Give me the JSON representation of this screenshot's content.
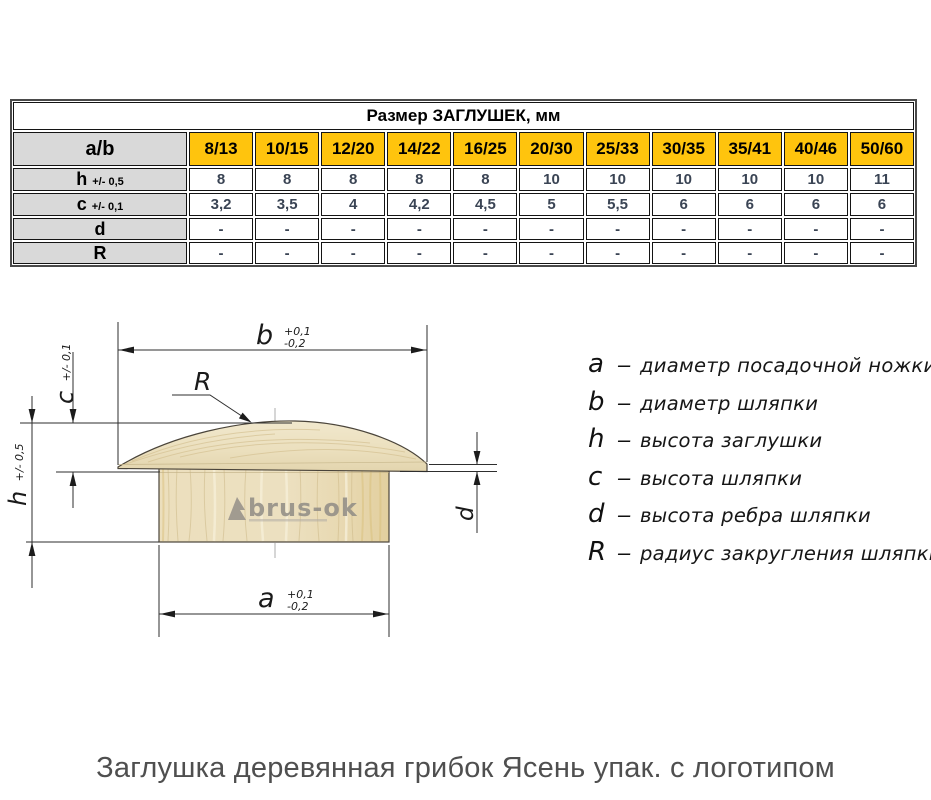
{
  "table": {
    "title": "Размер ЗАГЛУШЕК, мм",
    "corner_label": "a/b",
    "columns": [
      "8/13",
      "10/15",
      "12/20",
      "14/22",
      "16/25",
      "20/30",
      "25/33",
      "30/35",
      "35/41",
      "40/46",
      "50/60"
    ],
    "rows": [
      {
        "label": "h",
        "tolerance": "+/- 0,5",
        "values": [
          "8",
          "8",
          "8",
          "8",
          "8",
          "10",
          "10",
          "10",
          "10",
          "10",
          "11"
        ]
      },
      {
        "label": "c",
        "tolerance": "+/- 0,1",
        "values": [
          "3,2",
          "3,5",
          "4",
          "4,2",
          "4,5",
          "5",
          "5,5",
          "6",
          "6",
          "6",
          "6"
        ]
      },
      {
        "label": "d",
        "tolerance": "",
        "values": [
          "-",
          "-",
          "-",
          "-",
          "-",
          "-",
          "-",
          "-",
          "-",
          "-",
          "-"
        ]
      },
      {
        "label": "R",
        "tolerance": "",
        "values": [
          "-",
          "-",
          "-",
          "-",
          "-",
          "-",
          "-",
          "-",
          "-",
          "-",
          "-"
        ]
      }
    ]
  },
  "drawing": {
    "labels": {
      "b": "b",
      "b_tol_plus": "+0,1",
      "b_tol_minus": "-0,2",
      "a": "a",
      "a_tol_plus": "+0,1",
      "a_tol_minus": "-0,2",
      "h": "h",
      "h_tol": "+/- 0,5",
      "c": "c",
      "c_tol": "+/- 0,1",
      "d": "d",
      "R": "R"
    },
    "watermark": "brus-ok"
  },
  "legend": {
    "separator": "–",
    "items": [
      {
        "symbol": "a",
        "description": "диаметр посадочной ножки"
      },
      {
        "symbol": "b",
        "description": "диаметр шляпки"
      },
      {
        "symbol": "h",
        "description": "высота заглушки"
      },
      {
        "symbol": "c",
        "description": "высота шляпки"
      },
      {
        "symbol": "d",
        "description": "высота ребра шляпки"
      },
      {
        "symbol": "R",
        "description": "радиус закругления шляпки"
      }
    ]
  },
  "caption": "Заглушка деревянная грибок Ясень упак. с логотипом",
  "colors": {
    "header_yellow": "#FFC40D",
    "header_gray": "#d9d9d9",
    "value_text": "#3a4454",
    "wood_light": "#efe5c6",
    "wood_grain": "#d6c395",
    "caption_gray": "#4f4f4f"
  }
}
